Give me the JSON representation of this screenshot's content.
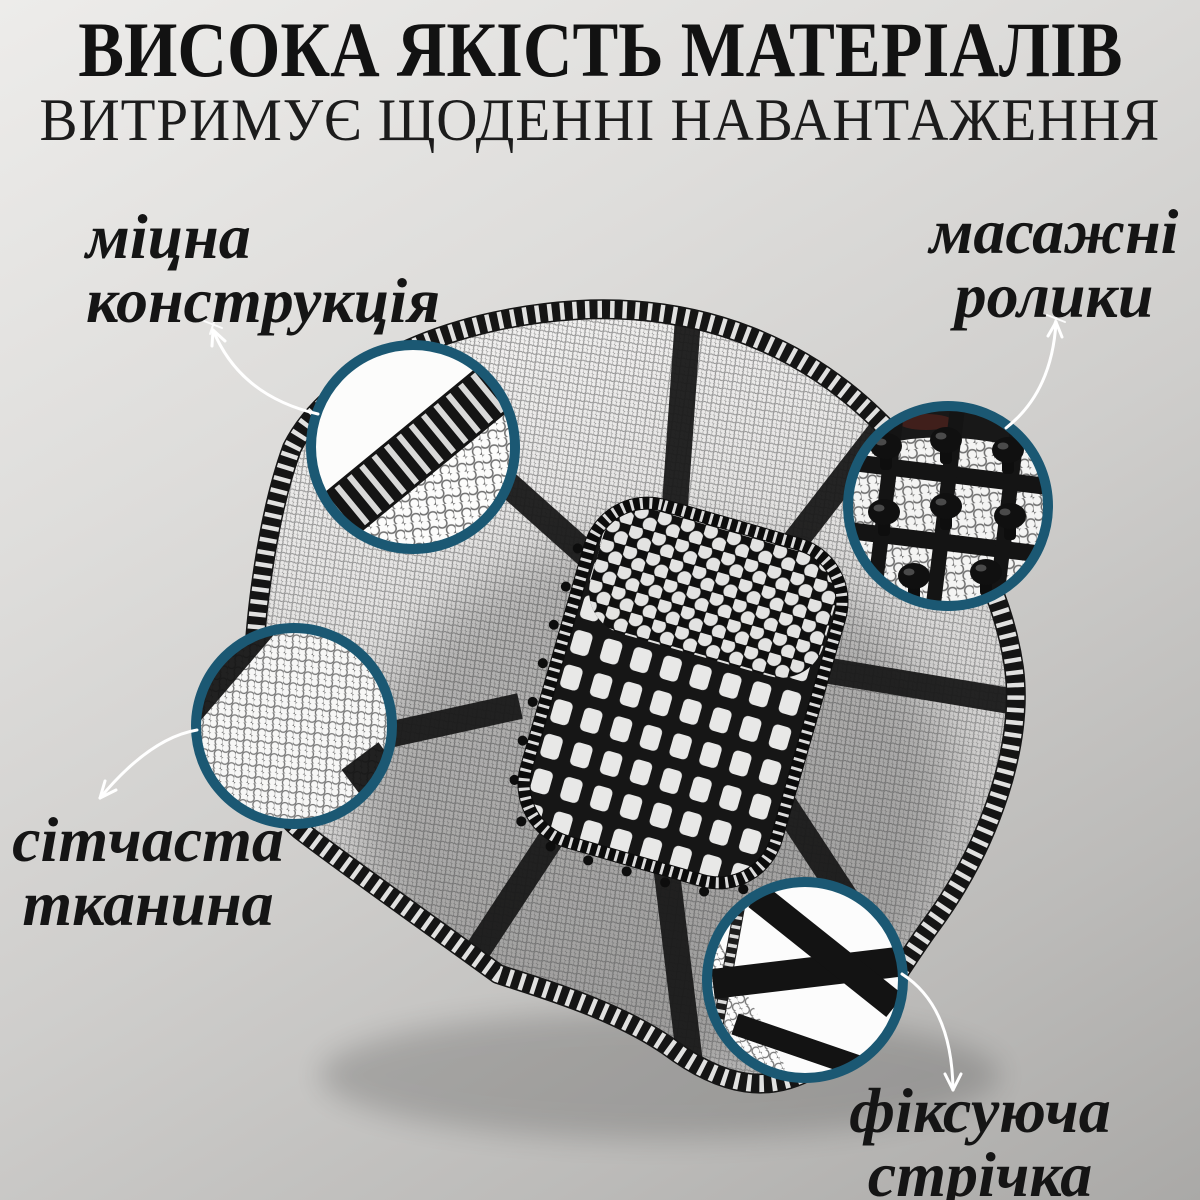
{
  "header": {
    "title": "ВИСОКА ЯКІСТЬ МАТЕРІАЛІВ",
    "subtitle": "ВИТРИМУЄ ЩОДЕННІ НАВАНТАЖЕННЯ"
  },
  "callouts": [
    {
      "id": "construction",
      "lines": [
        "міцна",
        "конструкція"
      ]
    },
    {
      "id": "rollers",
      "lines": [
        "масажні",
        "ролики"
      ]
    },
    {
      "id": "mesh",
      "lines": [
        "сітчаста",
        "тканина"
      ]
    },
    {
      "id": "strap",
      "lines": [
        "фіксуюча",
        "стрічка"
      ]
    }
  ],
  "colors": {
    "ring": "#1b5873",
    "arrow": "#ffffff",
    "text": "#151515",
    "strap_black": "#1a1a1a",
    "background_top": "#edecea",
    "background_bottom": "#aaa9a7"
  }
}
